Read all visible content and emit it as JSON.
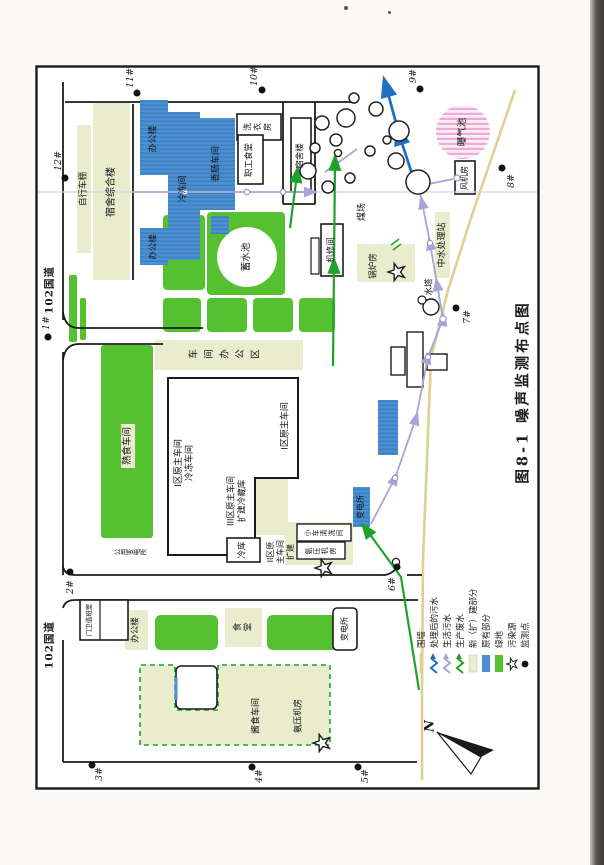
{
  "title": "图8-1  噪声监测布点图",
  "road": {
    "label": "102国道"
  },
  "compass": {
    "label": "N"
  },
  "points": [
    "1#",
    "2#",
    "3#",
    "4#",
    "5#",
    "6#",
    "7#",
    "8#",
    "9#",
    "10#",
    "11#",
    "12#"
  ],
  "legend": [
    {
      "label": "围墙",
      "symbol": "wall-line"
    },
    {
      "label": "处理后的污水",
      "symbol": "zigzag-blue"
    },
    {
      "label": "生活污水",
      "symbol": "zigzag-lavender"
    },
    {
      "label": "生产废水",
      "symbol": "zigzag-green"
    },
    {
      "label": "新（扩）建部分",
      "symbol": "box-pale"
    },
    {
      "label": "原有部分",
      "symbol": "box-blue"
    },
    {
      "label": "绿地",
      "symbol": "box-green"
    },
    {
      "label": "污染源",
      "symbol": "star"
    },
    {
      "label": "监测点",
      "symbol": "dot"
    }
  ],
  "labels": {
    "bike_shed": "自行车棚",
    "dorm_complex": "宿舍综合楼",
    "office_a": "办公楼",
    "office_b": "办公楼",
    "freezer": "冷冻间",
    "sausage": "香肠车间",
    "reservoir": "蓄水池",
    "laundry": "洗衣房",
    "staff_canteen": "职工食堂",
    "dorm": "宿舍楼",
    "machine_repair": "机修间",
    "boiler": "锅炉房",
    "coal_yard": "煤场",
    "water_tower": "水塔",
    "water_station": "中水处理站",
    "fan_room": "风机房",
    "aeration": "曝气池",
    "cooked_food": "熟食车间",
    "public_substation": "公用变电所",
    "workshop_office": "车间办公区",
    "zone1_freeze": "I区原主车间\n冷冻车间",
    "zone1": "I区原主车间",
    "zone3": "III区原主车间\n扩建冷藏库",
    "cold_store": "冷库",
    "zone2": "II区原\n主车间\n扩建",
    "car_wash": "小车清洗间",
    "ammonia_east": "氨压机房",
    "substation_east": "变电所",
    "gatehouse": "门卫值班室",
    "office_west": "办公楼",
    "canteen_west": "食堂",
    "substation_west": "变电所",
    "sauce_workshop": "酱食车间",
    "ammonia_west": "氨压机房"
  },
  "colors": {
    "green_area": "#55c130",
    "new_expand_pale": "#e9eccd",
    "original_blue": "#4b90d2",
    "aeration_pink": "#efaad6",
    "sewage_lavender": "#a9a4d6",
    "wall_beige": "#ddd191",
    "pipe_green": "#1ea32a",
    "pipe_blue": "#1f6fc4"
  }
}
